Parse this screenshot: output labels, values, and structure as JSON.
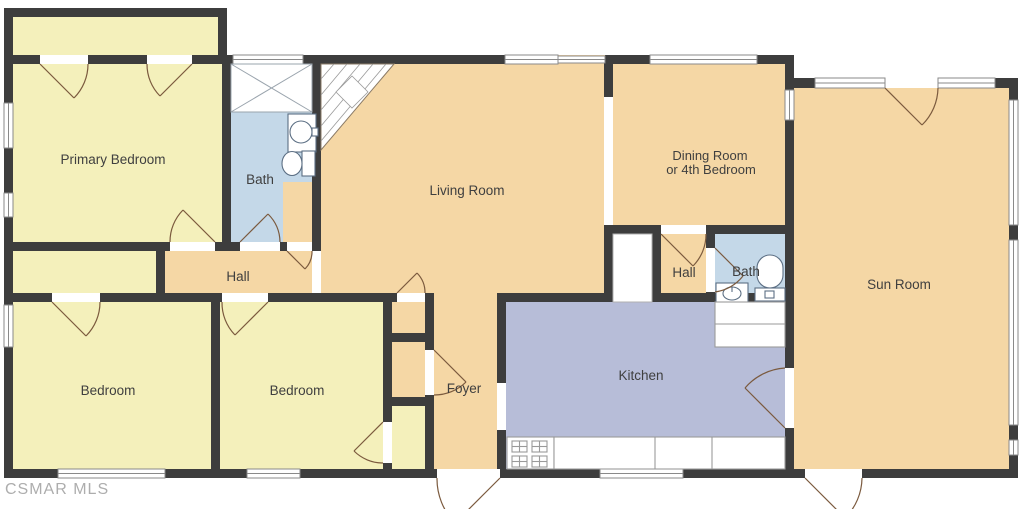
{
  "watermark": "CSMAR MLS",
  "colors": {
    "wall": "#3d3d3d",
    "room_yellow": "#f4f0bb",
    "room_tan": "#f5d7a5",
    "bath_blue": "#c4d8e8",
    "kitchen_lavender": "#b7bdd8",
    "door_arc": "#7b5a3e",
    "fixture_line": "#5c6f84",
    "window_line": "#8a8a8a",
    "counter_line": "#9a9a9a",
    "label_text": "#3f3f3f",
    "watermark_text": "#999999"
  },
  "rooms": {
    "primary_bedroom": "Primary Bedroom",
    "bath_left": "Bath",
    "living_room": "Living Room",
    "dining_line1": "Dining Room",
    "dining_line2": "or 4th Bedroom",
    "sun_room": "Sun Room",
    "hall_left": "Hall",
    "hall_right": "Hall",
    "bath_right": "Bath",
    "bedroom_left": "Bedroom",
    "bedroom_center": "Bedroom",
    "foyer": "Foyer",
    "kitchen": "Kitchen"
  }
}
